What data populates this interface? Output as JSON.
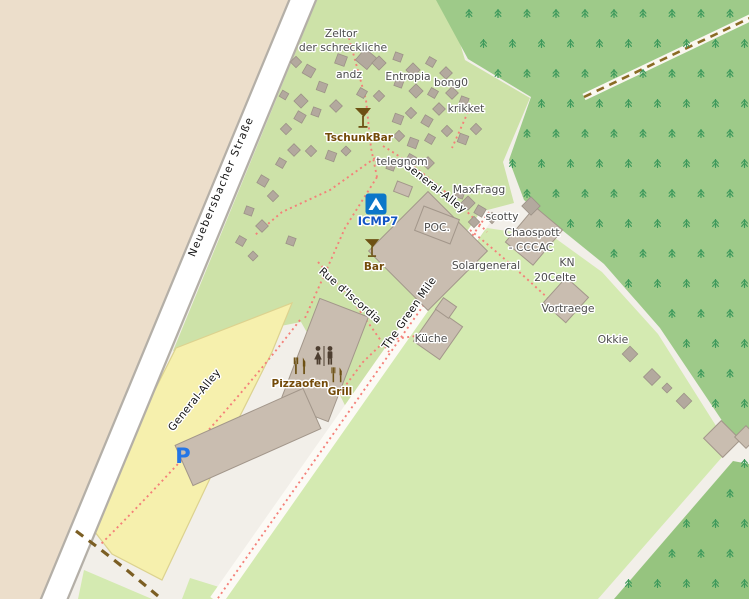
{
  "map_labels": {
    "streets": {
      "neuebersbacher": "Neuebersbacher Straße",
      "general_alley_top": "General-Alley",
      "general_alley_bottom": "General-Alley",
      "rue_discordia": "Rue d'Iscordia",
      "green_mile": "The Green Mile"
    },
    "places": {
      "zeltor_1": "Zeltor",
      "zeltor_2": "der schreckliche",
      "andz": "andz",
      "entropia": "Entropia",
      "bong0": "bong0",
      "krikket": "krikket",
      "telegnom": "telegnom",
      "maxfragg": "MaxFragg",
      "scotty": "scotty",
      "chaospott_1": "Chaospott",
      "chaospott_2": "- CCCAC",
      "poc": "POC.",
      "solargeneral": "Solargeneral",
      "kn": "KN",
      "celte": "20Celte",
      "vortraege": "Vortraege",
      "okkie": "Okkie",
      "kueche": "Küche"
    },
    "pois": {
      "tschunkbar": "TschunkBar",
      "bar": "Bar",
      "pizzaofen": "Pizzaofen",
      "grill": "Grill"
    },
    "special": {
      "icmp7": "ICMP7",
      "parking": "P"
    }
  },
  "icons": {
    "tschunkbar_icon": "cocktail-icon",
    "bar_icon": "cocktail-icon",
    "icmp7_icon": "campsite-icon",
    "wc_icon": "toilets-icon",
    "pizzaofen_icon": "restaurant-icon",
    "grill_icon": "restaurant-icon",
    "tree": "conifer-tree-icon",
    "parking": "parking-icon"
  },
  "colors": {
    "background": "#f2efe9",
    "farmland": "#ecdecb",
    "campground": "#cde2a8",
    "field": "#d4eab1",
    "forest": "#9eca89",
    "forest_dark": "#96c47f",
    "tree": "#3e9a5c",
    "parking_fill": "#f6f0ad",
    "parking_border": "#dcd28f",
    "road_fill": "#ffffff",
    "road_casing": "#b4afa7",
    "minor_road": "#fcfaf5",
    "path_dotted": "#f48079",
    "track_dash": "#7b5e23",
    "forest_track_dash": "#8a6b25",
    "building_fill": "#c9bdb0",
    "building_border": "#a2968a",
    "tent_fill": "#b3a99e",
    "tent_border": "#9c9287",
    "label_place": "#4c4c4c",
    "label_street": "#141414",
    "label_poi": "#734a08",
    "label_tourism_blue": "#1155c4",
    "parking_blue": "#2476e6",
    "icon_brown": "#6d5114",
    "icon_dark": "#4d3e30",
    "campsite_blue": "#0b77c9",
    "halo": "#ffffff"
  }
}
